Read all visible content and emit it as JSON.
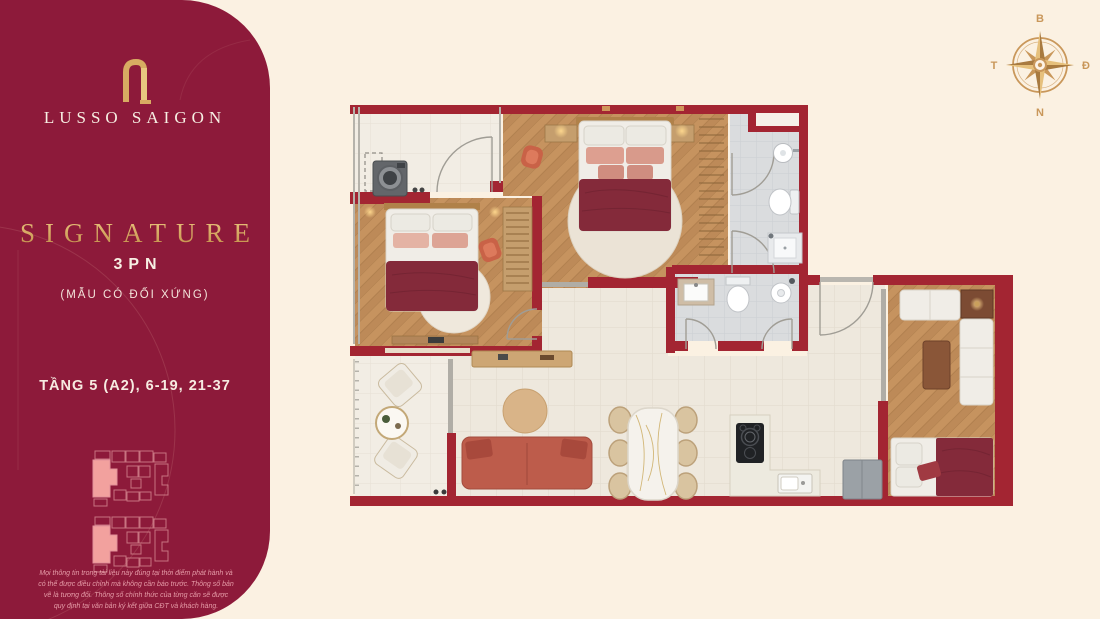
{
  "theme": {
    "cream": "#fbf1e2",
    "maroon": "#8d1a3a",
    "wall-red": "#a32532",
    "gold": "#c9975a",
    "gold-light": "#e6c07c",
    "wood": "#bd8a58",
    "tile": "#eee8dd",
    "bath-tile": "#dadcde",
    "blanket": "#842a3a",
    "terracotta": "#bd5c4b",
    "keyplan-pink": "#f2a19e"
  },
  "sidebar": {
    "brand": "LUSSO SAIGON",
    "title": "SIGNATURE",
    "bedrooms": "3PN",
    "note": "(MẪU CÓ ĐỐI XỨNG)",
    "floors": "TẦNG 5 (A2), 6-19, 21-37",
    "disclaimer": "Mọi thông tin trong tài liệu này đúng tại thời điểm phát hành và có thể được điều chỉnh mà không cần báo trước. Thông số bản vẽ là tương đối. Thông số chính thức của từng căn sẽ được quy định tại văn bản ký kết giữa CĐT và khách hàng."
  },
  "compass": {
    "north": "B",
    "east": "Đ",
    "south": "N",
    "west": "T"
  }
}
